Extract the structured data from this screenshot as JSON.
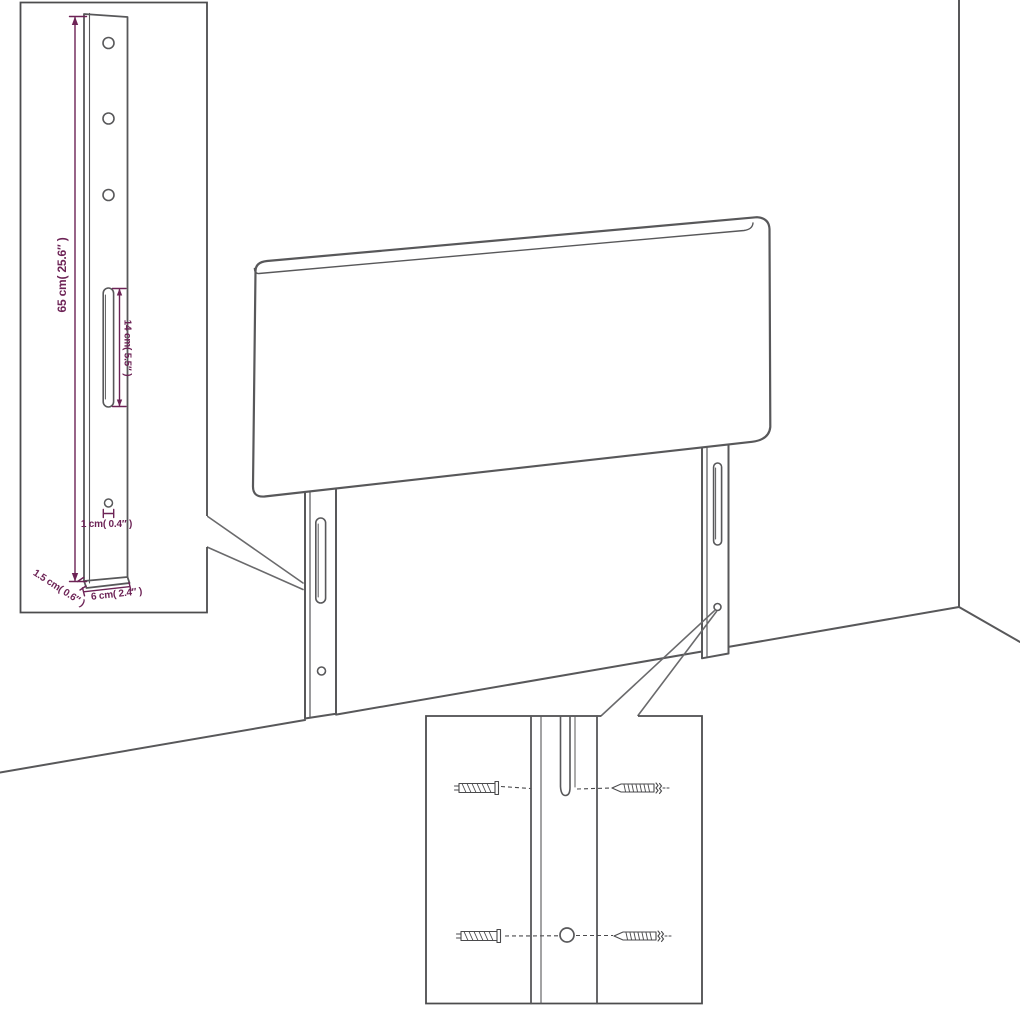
{
  "colors": {
    "background": "#ffffff",
    "outline": "#58585a",
    "hardware": "#4a4a4c",
    "dimension": "#6d2356"
  },
  "leg_detail_inset": {
    "height_label": "65 cm( 25.6″ )",
    "slot_label": "14 cm( 5.5″ )",
    "hole_label": "1 cm( 0.4″ )",
    "thickness_label": "1.5 cm( 0.6″ )",
    "width_label": "6 cm( 2.4″ )"
  },
  "mounting_detail_inset": {
    "icons": [
      "wall-plug-icon",
      "screw-icon"
    ]
  }
}
